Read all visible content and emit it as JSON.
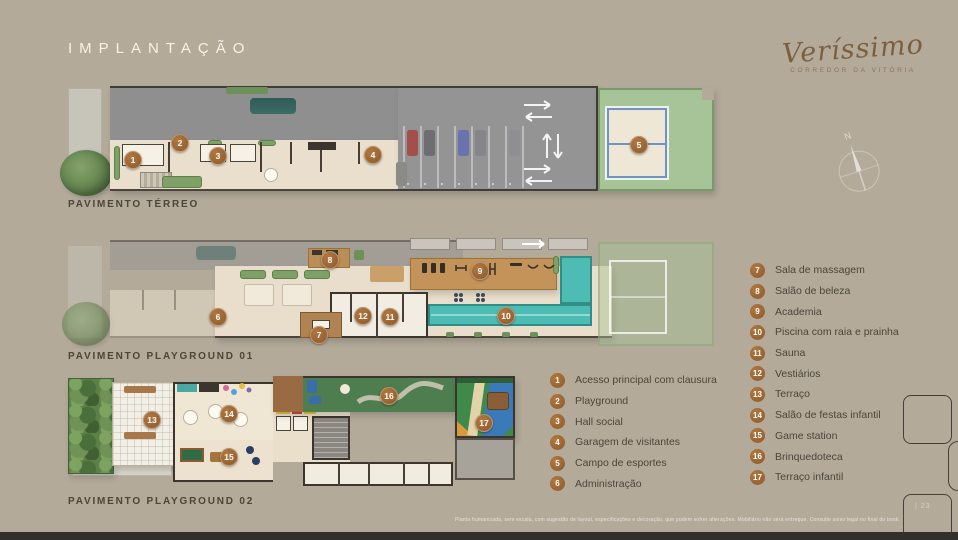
{
  "page": {
    "title": "IMPLANTAÇÃO",
    "page_number": "| 23",
    "disclaimer": "Planta humanizada, sem escala, com sugestão de layout, especificações e decoração, que podem sofrer alterações. Mobiliário não será entregue. Consulte aviso legal no final do book."
  },
  "brand": {
    "name": "Veríssimo",
    "tagline": "CORREDOR DA VITÓRIA"
  },
  "compass": {
    "north_label": "N"
  },
  "plans": [
    {
      "id": "terreo",
      "label": "PAVIMENTO TÉRREO",
      "markers": [
        "1",
        "2",
        "3",
        "4",
        "5"
      ]
    },
    {
      "id": "playground-01",
      "label": "PAVIMENTO PLAYGROUND 01",
      "markers": [
        "6",
        "7",
        "8",
        "9",
        "10",
        "11",
        "12"
      ]
    },
    {
      "id": "playground-02",
      "label": "PAVIMENTO PLAYGROUND 02",
      "markers": [
        "13",
        "14",
        "15",
        "16",
        "17"
      ]
    }
  ],
  "legend_left": {
    "items": [
      {
        "num": "1",
        "label": "Acesso principal com clausura"
      },
      {
        "num": "2",
        "label": "Playground"
      },
      {
        "num": "3",
        "label": "Hall social"
      },
      {
        "num": "4",
        "label": "Garagem de visitantes"
      },
      {
        "num": "5",
        "label": "Campo de esportes"
      },
      {
        "num": "6",
        "label": "Administração"
      }
    ]
  },
  "legend_right": {
    "items": [
      {
        "num": "7",
        "label": "Sala de massagem"
      },
      {
        "num": "8",
        "label": "Salão de beleza"
      },
      {
        "num": "9",
        "label": "Academia"
      },
      {
        "num": "10",
        "label": "Piscina com raia e prainha"
      },
      {
        "num": "11",
        "label": "Sauna"
      },
      {
        "num": "12",
        "label": "Vestiários"
      },
      {
        "num": "13",
        "label": "Terraço"
      },
      {
        "num": "14",
        "label": "Salão de festas infantil"
      },
      {
        "num": "15",
        "label": "Game station"
      },
      {
        "num": "16",
        "label": "Brinquedoteca"
      },
      {
        "num": "17",
        "label": "Terraço infantil"
      }
    ]
  },
  "colors": {
    "background": "#b3aa9a",
    "badge_brown": "#9c6733",
    "brand_brown": "#7d5f40",
    "pool_teal": "#4cbcb4",
    "lawn_green": "#a6c497",
    "deck_wood": "#c39359",
    "label_dark": "#4c4538",
    "title_white": "#f6f2e9"
  }
}
